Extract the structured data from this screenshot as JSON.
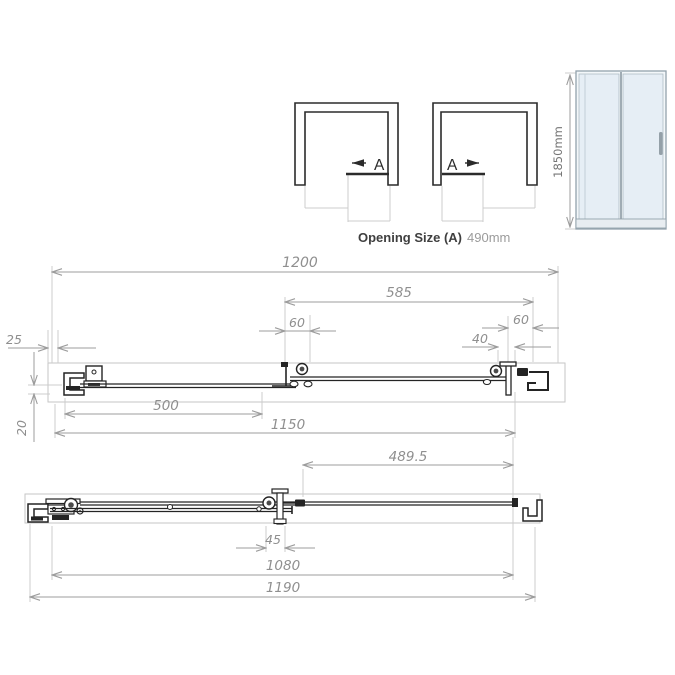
{
  "top_views": {
    "left_label": "A",
    "right_label": "A",
    "caption": "Opening Size (A)",
    "caption_value": "490mm"
  },
  "front_view": {
    "height": "1850mm"
  },
  "plan_section": {
    "overall_width": "1200",
    "door_panel": "585",
    "overlap_left": "60",
    "overlap_right": "60",
    "roller_offset": "40",
    "wall_profile": "25",
    "fixed_panel": "500",
    "inner_width": "1150",
    "profile_depth": "20"
  },
  "bottom_plan": {
    "sliding_opening": "489.5",
    "bracket_offset": "45",
    "inner_width": "1080",
    "overall_width": "1190"
  },
  "colors": {
    "glass": "#e6eef5",
    "line_dark": "#242424",
    "dim_gray": "#9c9c9c"
  }
}
